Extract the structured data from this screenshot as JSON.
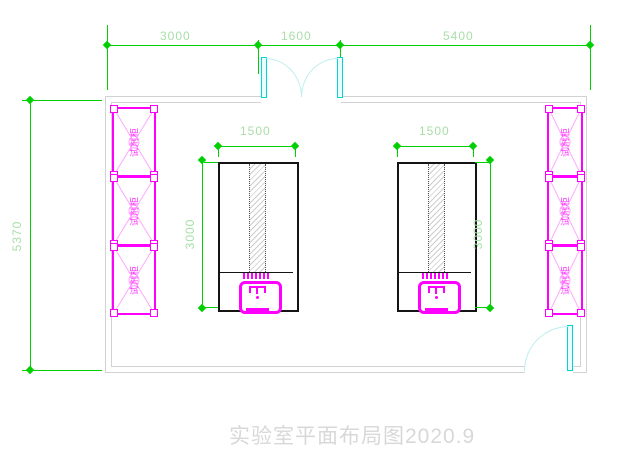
{
  "title": "实验室平面布局图2020.9",
  "colors": {
    "dimension_green": "#00cf00",
    "dimension_text_green": "#a8dea8",
    "wall_gray": "#d2d2d2",
    "furniture_magenta": "#ff00ff",
    "door_cyan": "#00d6d6",
    "door_arc_cyan": "#bfeeee",
    "bench_black": "#141414",
    "title_gray": "#d8d8d8"
  },
  "dims": {
    "top_left": "3000",
    "top_mid": "1600",
    "top_right": "5400",
    "left_overall": "5370",
    "bench_left_width": "1500",
    "bench_left_length": "3000",
    "bench_right_width": "1500",
    "bench_right_length": "3000"
  },
  "cabinets": {
    "left": [
      {
        "label": "试剂柜"
      },
      {
        "label": "试剂柜"
      },
      {
        "label": "试剂柜"
      }
    ],
    "right": [
      {
        "label": "试剂柜"
      },
      {
        "label": "试剂柜"
      },
      {
        "label": "试剂柜"
      }
    ]
  },
  "icons": {
    "sink": "sink-faucet-icon",
    "door_swing": "door-swing-arc-icon",
    "cabinet_brace": "cabinet-x-brace-icon"
  }
}
